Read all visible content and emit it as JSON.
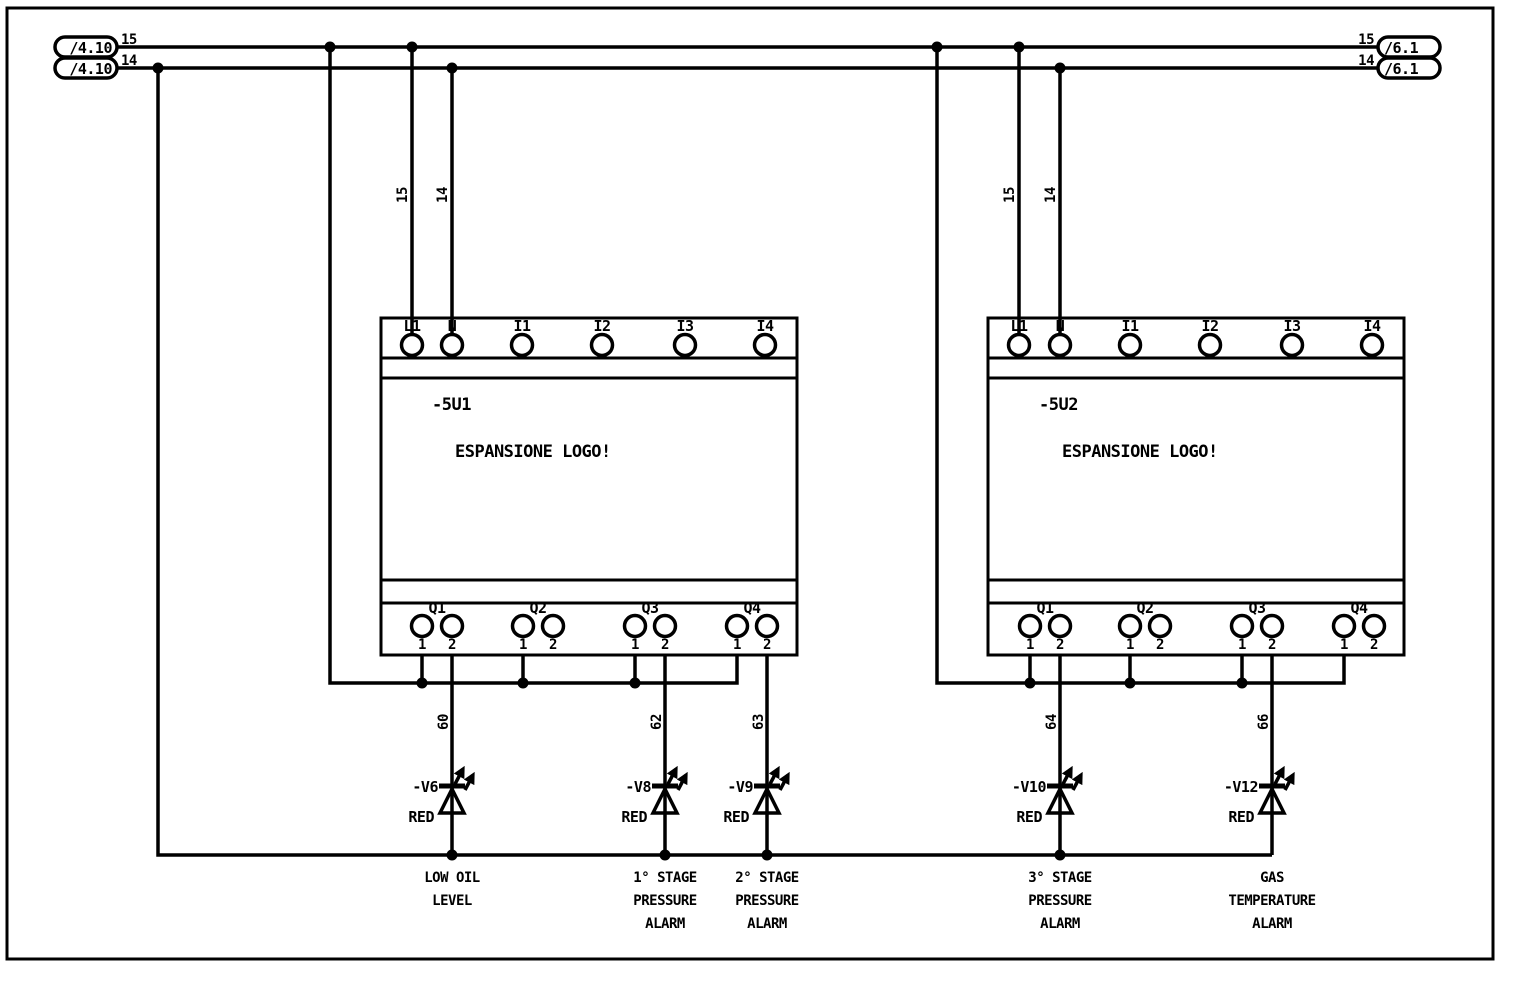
{
  "diagram": {
    "type": "electrical-schematic",
    "rails": {
      "line_numbers": [
        "15",
        "14"
      ],
      "left_refs": [
        "/4.10",
        "/4.10"
      ],
      "right_refs": [
        "/6.1",
        "/6.1"
      ]
    },
    "pin_labels": [
      "1",
      "2"
    ],
    "modules": [
      {
        "tag": "-5U1",
        "title": "ESPANSIONE LOGO!",
        "top_terminals": [
          "L1",
          "N",
          "I1",
          "I2",
          "I3",
          "I4"
        ],
        "output_groups": [
          "Q1",
          "Q2",
          "Q3",
          "Q4"
        ]
      },
      {
        "tag": "-5U2",
        "title": "ESPANSIONE LOGO!",
        "top_terminals": [
          "L1",
          "N",
          "I1",
          "I2",
          "I3",
          "I4"
        ],
        "output_groups": [
          "Q1",
          "Q2",
          "Q3",
          "Q4"
        ]
      }
    ],
    "leds": [
      {
        "wire": "60",
        "tag": "-V6",
        "color": "RED",
        "function": [
          "LOW OIL",
          "LEVEL"
        ]
      },
      {
        "wire": "62",
        "tag": "-V8",
        "color": "RED",
        "function": [
          "1° STAGE",
          "PRESSURE",
          "ALARM"
        ]
      },
      {
        "wire": "63",
        "tag": "-V9",
        "color": "RED",
        "function": [
          "2° STAGE",
          "PRESSURE",
          "ALARM"
        ]
      },
      {
        "wire": "64",
        "tag": "-V10",
        "color": "RED",
        "function": [
          "3° STAGE",
          "PRESSURE",
          "ALARM"
        ]
      },
      {
        "wire": "66",
        "tag": "-V12",
        "color": "RED",
        "function": [
          "GAS",
          "TEMPERATURE",
          "ALARM"
        ]
      }
    ],
    "colors": {
      "ink": "#000000",
      "paper": "#ffffff"
    }
  }
}
